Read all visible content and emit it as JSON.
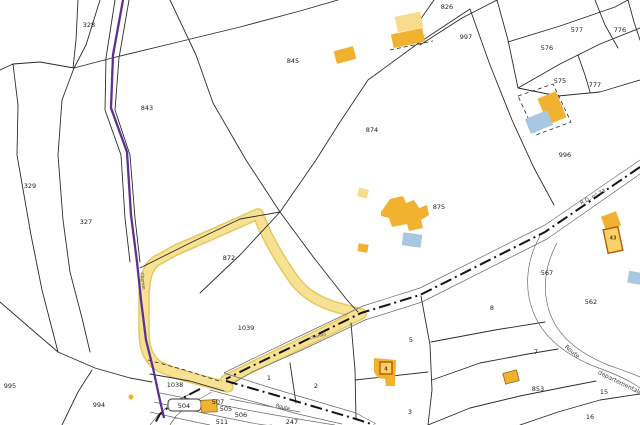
{
  "map": {
    "type": "cadastral-parcel-map",
    "parcel_labels": [
      {
        "text": "328",
        "x": 89,
        "y": 25
      },
      {
        "text": "843",
        "x": 147,
        "y": 108
      },
      {
        "text": "329",
        "x": 30,
        "y": 186
      },
      {
        "text": "327",
        "x": 86,
        "y": 222
      },
      {
        "text": "845",
        "x": 293,
        "y": 61
      },
      {
        "text": "826",
        "x": 447,
        "y": 7
      },
      {
        "text": "997",
        "x": 466,
        "y": 37
      },
      {
        "text": "577",
        "x": 577,
        "y": 30
      },
      {
        "text": "776",
        "x": 620,
        "y": 30
      },
      {
        "text": "576",
        "x": 547,
        "y": 48
      },
      {
        "text": "575",
        "x": 560,
        "y": 81
      },
      {
        "text": "777",
        "x": 595,
        "y": 85
      },
      {
        "text": "996",
        "x": 565,
        "y": 155
      },
      {
        "text": "874",
        "x": 372,
        "y": 130
      },
      {
        "text": "875",
        "x": 439,
        "y": 207
      },
      {
        "text": "872",
        "x": 229,
        "y": 258
      },
      {
        "text": "1039",
        "x": 246,
        "y": 328
      },
      {
        "text": "567",
        "x": 547,
        "y": 273
      },
      {
        "text": "562",
        "x": 591,
        "y": 302
      },
      {
        "text": "8",
        "x": 492,
        "y": 308
      },
      {
        "text": "5",
        "x": 411,
        "y": 340
      },
      {
        "text": "7",
        "x": 536,
        "y": 352
      },
      {
        "text": "853",
        "x": 538,
        "y": 389
      },
      {
        "text": "15",
        "x": 604,
        "y": 392
      },
      {
        "text": "16",
        "x": 590,
        "y": 417
      },
      {
        "text": "1",
        "x": 269,
        "y": 378
      },
      {
        "text": "2",
        "x": 316,
        "y": 386
      },
      {
        "text": "3",
        "x": 410,
        "y": 412
      },
      {
        "text": "995",
        "x": 10,
        "y": 386
      },
      {
        "text": "994",
        "x": 99,
        "y": 405
      },
      {
        "text": "1038",
        "x": 175,
        "y": 385
      },
      {
        "text": "507",
        "x": 218,
        "y": 402
      },
      {
        "text": "505",
        "x": 226,
        "y": 409
      },
      {
        "text": "506",
        "x": 241,
        "y": 415
      },
      {
        "text": "511",
        "x": 222,
        "y": 422
      },
      {
        "text": "247",
        "x": 292,
        "y": 422
      },
      {
        "text": "504",
        "x": 184,
        "y": 406
      }
    ],
    "road_labels": [
      {
        "text": "R.D. n° 23",
        "x": 593,
        "y": 197,
        "rot": -28,
        "size": 5.5
      },
      {
        "text": "Route",
        "x": 572,
        "y": 352,
        "rot": 40,
        "size": 6
      },
      {
        "text": "départementale",
        "x": 620,
        "y": 383,
        "rot": 26,
        "size": 6
      },
      {
        "text": "Route",
        "x": 283,
        "y": 407,
        "rot": 14,
        "size": 5
      },
      {
        "text": "Chemin",
        "x": 143,
        "y": 281,
        "rot": 84,
        "size": 4.5
      },
      {
        "text": "chemin",
        "x": 318,
        "y": 336,
        "rot": -14,
        "size": 4.5
      }
    ],
    "building_labels": [
      {
        "text": "43",
        "x": 613,
        "y": 238
      },
      {
        "text": "4",
        "x": 386,
        "y": 369
      }
    ],
    "colors": {
      "background": "#ffffff",
      "boundary_line": "#2b2b2b",
      "road_edge": "#6a6a6a",
      "road_centerline": "#141414",
      "highlight_path_fill": "#f6e292",
      "highlight_path_edge": "#e6c861",
      "building_fill": "#f0b22f",
      "building_light_fill": "#f7dc8e",
      "building_blue_fill": "#a9c7e0",
      "building_selected_fill": "#f9d06a",
      "building_selected_stroke": "#b35a00",
      "commune_boundary": "#5d3191"
    }
  }
}
